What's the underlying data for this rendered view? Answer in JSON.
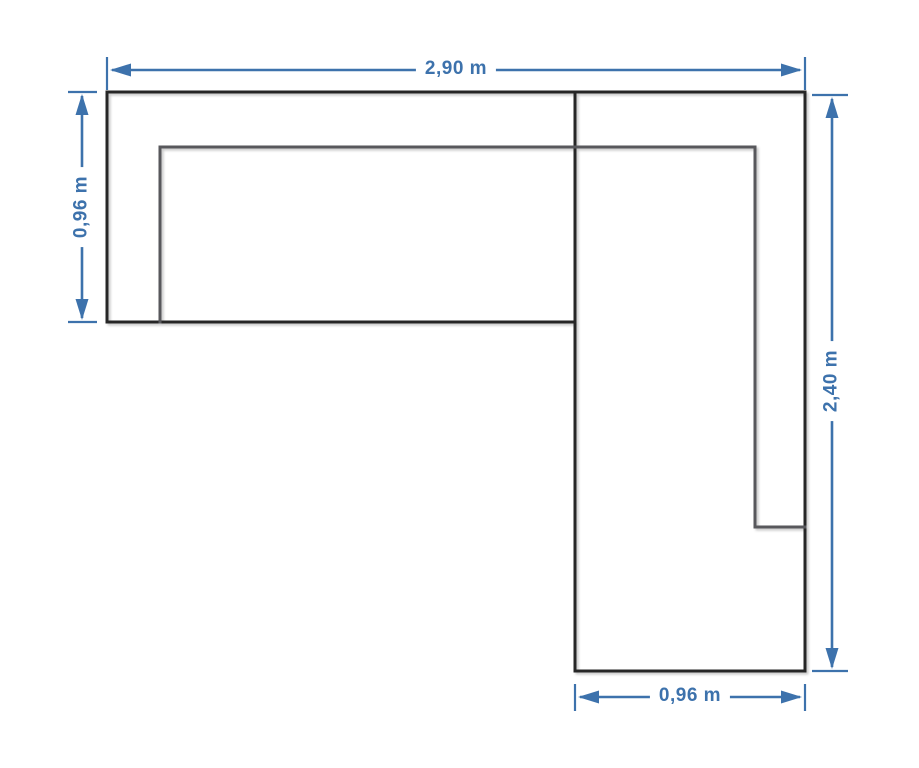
{
  "diagram": {
    "colors": {
      "dimension_blue": "#3d72ac",
      "outline_dark": "#262626",
      "inner_gray": "#59595b",
      "background": "#ffffff"
    },
    "dimensions": {
      "top_width": {
        "label": "2,90 m"
      },
      "left_depth": {
        "label": "0,96 m"
      },
      "right_length": {
        "label": "2,40 m"
      },
      "bottom_width": {
        "label": "0,96 m"
      }
    }
  }
}
